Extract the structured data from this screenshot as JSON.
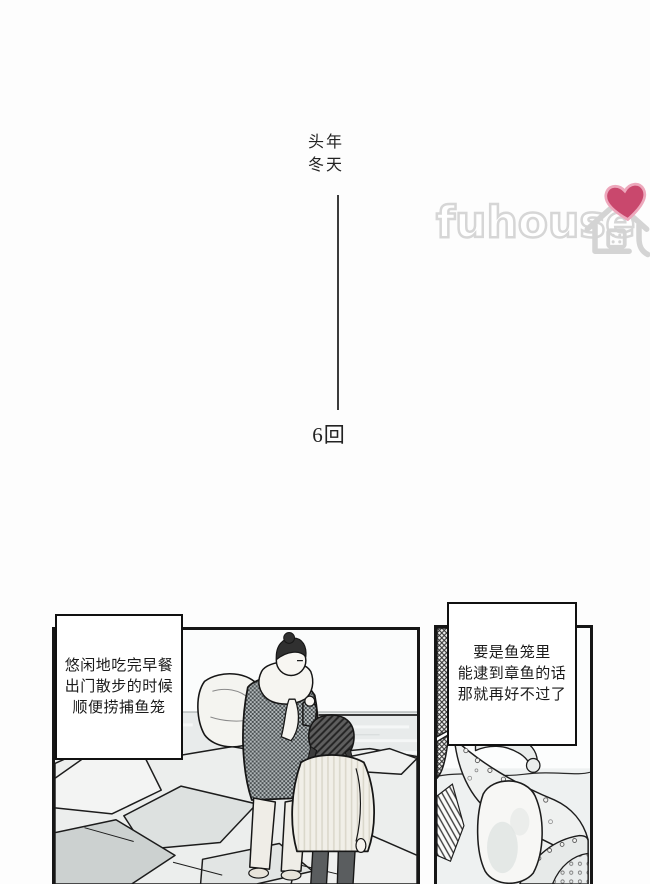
{
  "page": {
    "background": "#fdfdfd",
    "panel_border_color": "#161616"
  },
  "title": {
    "line1": "头年",
    "line2": "冬天"
  },
  "chapter": {
    "label": "6回"
  },
  "watermark": {
    "text": "fuhouse",
    "outline_color": "#d6d6d6",
    "heart_color": "#c9486d"
  },
  "panels": {
    "left": {
      "scene": "couple-on-rocky-seashore",
      "caption": {
        "lines": [
          "悠闲地吃完早餐",
          "出门散步的时候",
          "顺便捞捕鱼笼"
        ]
      }
    },
    "right": {
      "scene": "octopus-underwater",
      "caption": {
        "lines": [
          "要是鱼笼里",
          "能逮到章鱼的话",
          "那就再好不过了"
        ]
      }
    }
  }
}
